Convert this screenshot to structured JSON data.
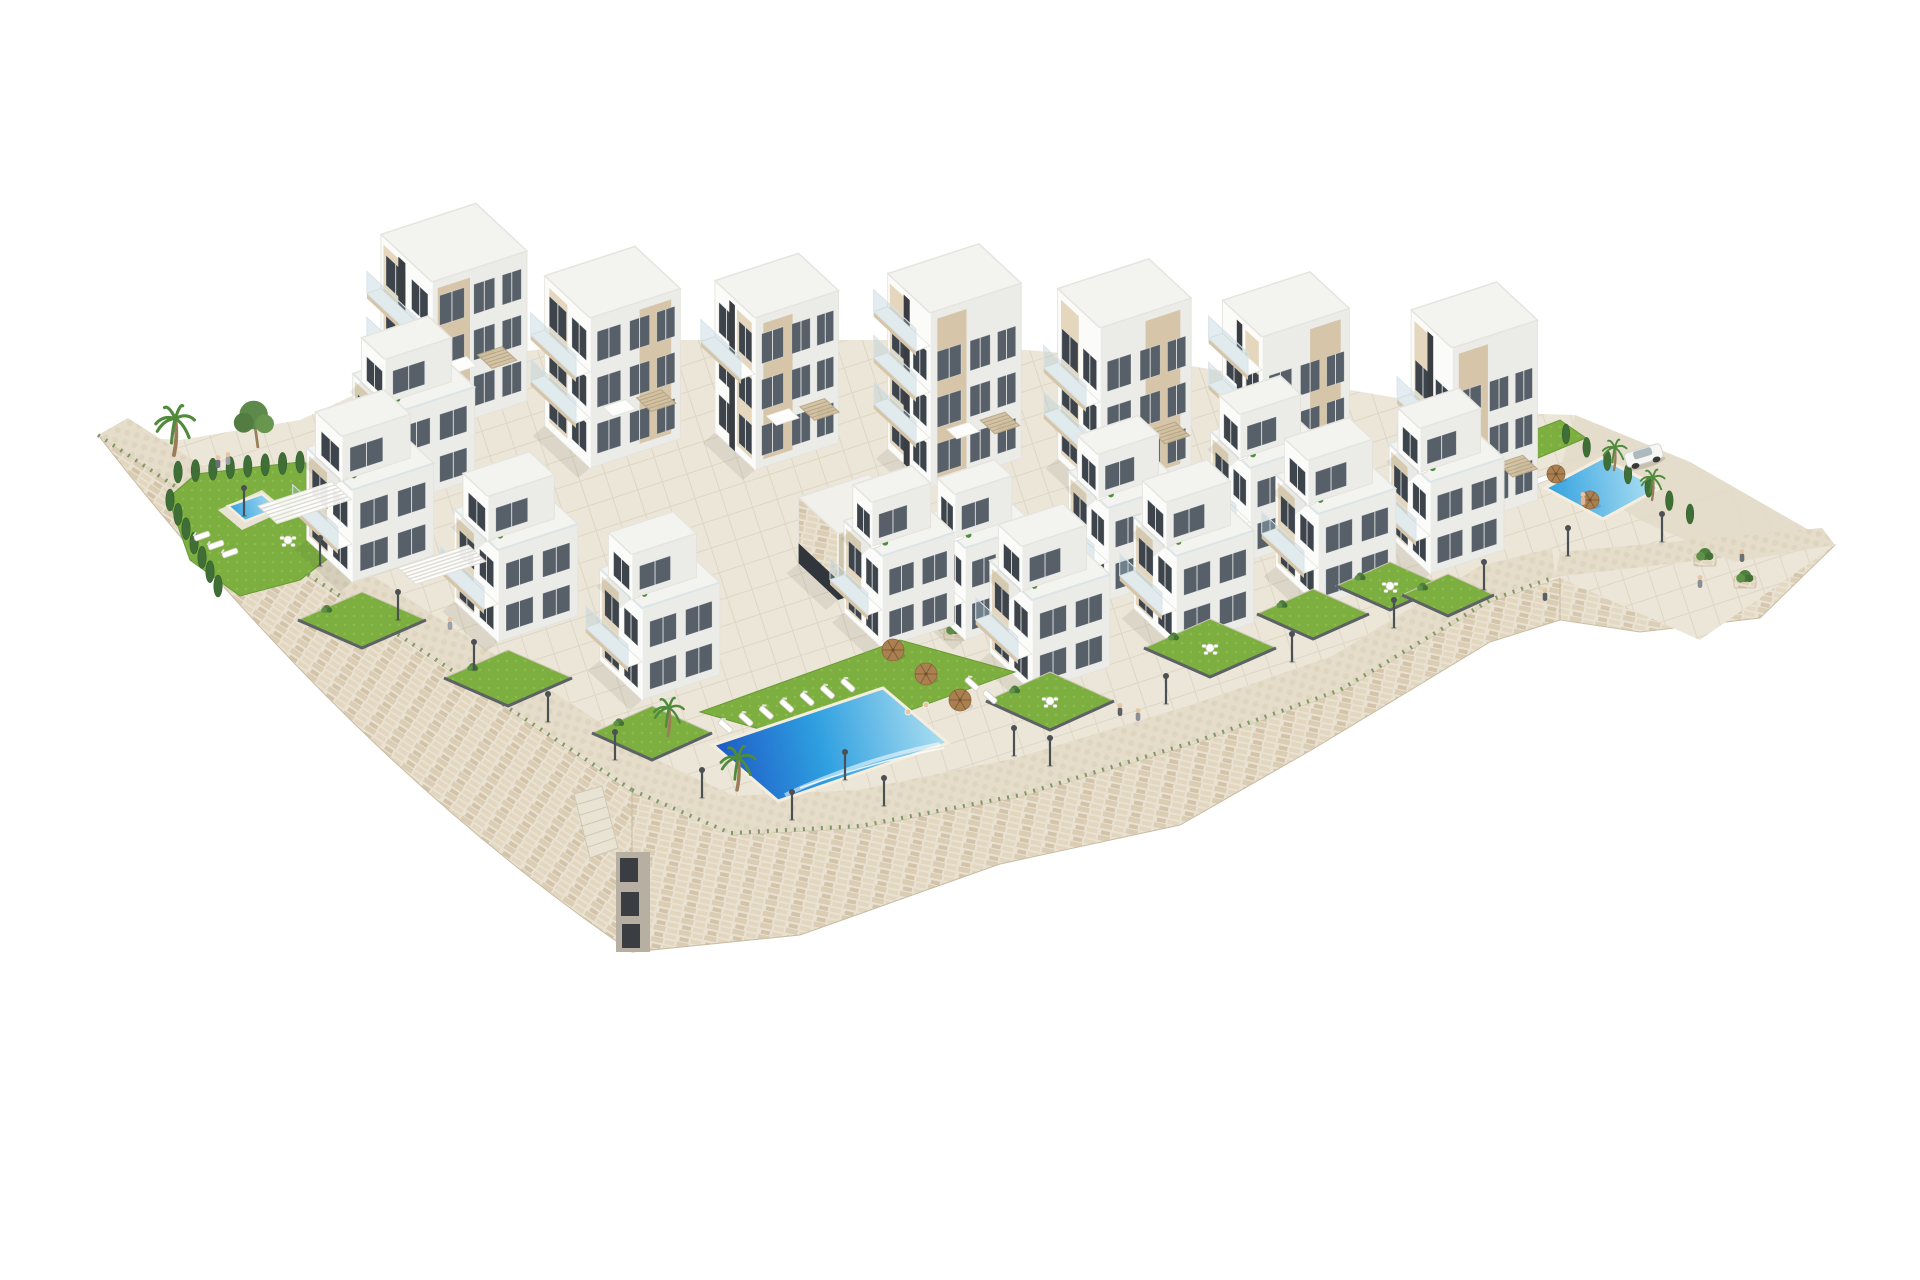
{
  "meta": {
    "description": "Aerial 3D architectural rendering of a white hillside apartment complex with stepped buildings, rooftop pergolas, private gardens, three swimming pools, stone retaining walls, lamp-lined promenades, palm trees and a parked car on a white background",
    "image_type": "3D architectural render",
    "counts": {
      "apartment_towers": 7,
      "front_villas": 8,
      "mid_villas": 4,
      "pools": 3,
      "lamp_posts": 18,
      "people": 11,
      "cars": 1
    }
  },
  "palette": {
    "bg": "#ffffff",
    "wallStone": "#e9e1d1",
    "wallCourseA": "#dbcdb4",
    "wallCourseB": "#e2d6bf",
    "wallCourseC": "#d3c4a9",
    "wallJoint": "#c9bba2",
    "pavement": "#ece6d9",
    "pavementLine": "#ded6c5",
    "promenade": "#e5ddc9",
    "cobble": "#dcd2bd",
    "slope": "#e4dbc8",
    "lawn": "#7caf3f",
    "lawnDot": "#8fbe52",
    "hedge": "#3f6f36",
    "hedgeDark": "#35602e",
    "poolDeep": "#1e56c4",
    "poolMid": "#2e9fe0",
    "poolLight": "#b5e3f2",
    "poolFoam": "#eef9fc",
    "white": "#fbfbf9",
    "whiteShade": "#ebebe7",
    "roof": "#f3f3f0",
    "roofLight": "#f7f8f6",
    "beigeL": "#e5d7bd",
    "beigeR": "#d6c5a8",
    "pergolaWood": "#d3c2a2",
    "pergolaLine": "#b6a686",
    "glassDark": "#3d444b",
    "glassMid": "#576069",
    "glassTint": "rgba(168,198,210,0.32)",
    "glassLine": "#d9e4e8",
    "charcoal": "#3a3e42",
    "fence": "#5c6165",
    "lamp": "#4b5054",
    "trunk": "#9b7d5a",
    "palm": "#4f8b3b",
    "pine": "#5d8a4a",
    "parasol": "#ab8050",
    "carBody": "#f6f6f4",
    "carGlass": "#aeb9be",
    "skin": "#e7c6a4",
    "edge": "#e3e1da",
    "shadow": "rgba(80,75,60,0.10)"
  },
  "scene": {
    "canvas": {
      "w": 1920,
      "h": 1280
    },
    "axes": {
      "dl": [
        -0.73,
        -0.68
      ],
      "dr": [
        0.95,
        -0.31
      ]
    },
    "plateau": [
      [
        98,
        435
      ],
      [
        180,
        440
      ],
      [
        300,
        420
      ],
      [
        430,
        360
      ],
      [
        640,
        340
      ],
      [
        900,
        340
      ],
      [
        1150,
        360
      ],
      [
        1350,
        390
      ],
      [
        1480,
        412
      ],
      [
        1575,
        415
      ],
      [
        1690,
        462
      ],
      [
        1835,
        545
      ],
      [
        1700,
        640
      ],
      [
        1560,
        578
      ],
      [
        1490,
        602
      ],
      [
        1340,
        692
      ],
      [
        1200,
        742
      ],
      [
        1020,
        797
      ],
      [
        858,
        827
      ],
      [
        728,
        835
      ],
      [
        632,
        792
      ]
    ],
    "slope": [
      [
        1575,
        415
      ],
      [
        1690,
        462
      ],
      [
        1835,
        545
      ],
      [
        1735,
        562
      ],
      [
        1640,
        520
      ],
      [
        1560,
        470
      ]
    ],
    "wallLeft": {
      "tip": [
        98,
        435
      ],
      "corner": [
        632,
        792
      ],
      "bottom": [
        632,
        952
      ],
      "ctrl": [
        350,
        760
      ]
    },
    "wallFront": [
      [
        632,
        792
      ],
      [
        730,
        835
      ],
      [
        860,
        828
      ],
      [
        1020,
        797
      ],
      [
        1200,
        742
      ],
      [
        1340,
        692
      ],
      [
        1490,
        602
      ],
      [
        1555,
        577
      ],
      [
        1552,
        548
      ],
      [
        1480,
        566
      ],
      [
        1332,
        656
      ],
      [
        1194,
        704
      ],
      [
        1016,
        758
      ],
      [
        858,
        790
      ],
      [
        734,
        796
      ],
      [
        644,
        754
      ]
    ],
    "wallFrontFace": [
      [
        632,
        792
      ],
      [
        730,
        835
      ],
      [
        860,
        828
      ],
      [
        1020,
        797
      ],
      [
        1200,
        742
      ],
      [
        1340,
        692
      ],
      [
        1490,
        602
      ],
      [
        1560,
        578
      ],
      [
        1560,
        620
      ],
      [
        1490,
        642
      ],
      [
        1313,
        749
      ],
      [
        1180,
        825
      ],
      [
        1000,
        864
      ],
      [
        800,
        935
      ],
      [
        632,
        952
      ]
    ],
    "wallRight": [
      [
        1560,
        578
      ],
      [
        1835,
        545
      ],
      [
        1760,
        618
      ],
      [
        1640,
        632
      ],
      [
        1560,
        620
      ]
    ],
    "promenadeLeft": [
      [
        98,
        435
      ],
      [
        632,
        790
      ],
      [
        646,
        752
      ],
      [
        128,
        418
      ]
    ],
    "promenadeRight": [
      [
        1555,
        577
      ],
      [
        1835,
        545
      ],
      [
        1822,
        528
      ],
      [
        1560,
        552
      ]
    ],
    "tuftLeft": [
      [
        98,
        435
      ],
      [
        632,
        790
      ]
    ],
    "tuftFront": [
      [
        632,
        790
      ],
      [
        730,
        833
      ],
      [
        860,
        826
      ],
      [
        1020,
        795
      ],
      [
        1200,
        740
      ],
      [
        1340,
        690
      ],
      [
        1490,
        600
      ],
      [
        1555,
        577
      ]
    ],
    "garageNotch": {
      "x": 616,
      "y": 852,
      "w": 34,
      "h": 100
    },
    "cornerStairs": [
      [
        574,
        794
      ],
      [
        602,
        786
      ],
      [
        618,
        848
      ],
      [
        590,
        858
      ]
    ],
    "towers": [
      {
        "name": "tower-1",
        "s": [
          432,
          432
        ],
        "wl": 70,
        "wr": 100,
        "h": 150,
        "slot": 0.52,
        "balconies": [
          1,
          2
        ],
        "panelL": [
          0.56,
          0.95
        ],
        "panelR": [
          0.06,
          0.4
        ]
      },
      {
        "name": "tower-2",
        "s": [
          590,
          468
        ],
        "wl": 62,
        "wr": 95,
        "h": 150,
        "balconies": [
          1,
          2
        ],
        "panelL": [
          0.5,
          0.9
        ],
        "panelR": [
          0.55,
          0.9
        ]
      },
      {
        "name": "tower-3",
        "s": [
          755,
          470
        ],
        "wl": 55,
        "wr": 88,
        "h": 152,
        "slot": 0.5,
        "balconies": [
          2
        ],
        "panelL": [
          0.08,
          0.45
        ],
        "panelR": [
          0.1,
          0.45
        ]
      },
      {
        "name": "tower-4",
        "s": [
          930,
          488
        ],
        "wl": 58,
        "wr": 96,
        "h": 175,
        "slot": 0.48,
        "balconies": [
          1,
          2,
          3
        ],
        "panelL": [
          0.55,
          0.95
        ],
        "panelR": [
          0.08,
          0.4
        ]
      },
      {
        "name": "tower-5",
        "s": [
          1100,
          498
        ],
        "wl": 58,
        "wr": 96,
        "h": 170,
        "balconies": [
          1,
          2
        ],
        "panelL": [
          0.5,
          0.92
        ],
        "panelR": [
          0.5,
          0.88
        ]
      },
      {
        "name": "tower-6",
        "s": [
          1262,
          512
        ],
        "wl": 54,
        "wr": 92,
        "h": 175,
        "slot": 0.5,
        "balconies": [
          2,
          3
        ],
        "panelL": [
          0.08,
          0.42
        ],
        "panelR": [
          0.55,
          0.9
        ]
      },
      {
        "name": "tower-7",
        "s": [
          1452,
          528
        ],
        "wl": 56,
        "wr": 90,
        "h": 180,
        "slot": 0.46,
        "balconies": [
          1,
          2
        ],
        "panelL": [
          0.52,
          0.92
        ],
        "panelR": [
          0.08,
          0.42
        ]
      }
    ],
    "towerWin": {
      "base": 12,
      "fh": 46,
      "wh": 30,
      "floors": 3,
      "colsL": [
        [
          0.08,
          0.4
        ],
        [
          0.52,
          0.9
        ]
      ],
      "colsR": [
        [
          0.08,
          0.34
        ],
        [
          0.44,
          0.66
        ],
        [
          0.74,
          0.94
        ]
      ]
    },
    "midVillas": [
      {
        "name": "mid-villa-1",
        "s": [
          395,
          505
        ],
        "wl": 58,
        "wr": 84
      },
      {
        "name": "mid-villa-2",
        "s": [
          965,
          640
        ],
        "wl": 50,
        "wr": 74
      },
      {
        "name": "mid-villa-3",
        "s": [
          1108,
          600
        ],
        "wl": 54,
        "wr": 78
      },
      {
        "name": "mid-villa-4",
        "s": [
          1250,
          560
        ],
        "wl": 54,
        "wr": 78
      }
    ],
    "villas": [
      {
        "name": "villa-1",
        "s": [
          352,
          582
        ],
        "wl": 62,
        "wr": 86
      },
      {
        "name": "villa-2",
        "s": [
          498,
          642
        ],
        "wl": 60,
        "wr": 84
      },
      {
        "name": "villa-3",
        "s": [
          642,
          700
        ],
        "wl": 58,
        "wr": 82
      },
      {
        "name": "villa-4",
        "s": [
          882,
          648
        ],
        "wl": 52,
        "wr": 76
      },
      {
        "name": "villa-5",
        "s": [
          1032,
          692
        ],
        "wl": 58,
        "wr": 82
      },
      {
        "name": "villa-6",
        "s": [
          1176,
          648
        ],
        "wl": 58,
        "wr": 82
      },
      {
        "name": "villa-7",
        "s": [
          1318,
          606
        ],
        "wl": 58,
        "wr": 82
      },
      {
        "name": "villa-8",
        "s": [
          1430,
          574
        ],
        "wl": 56,
        "wr": 78
      }
    ],
    "villaWin": {
      "base": 8,
      "fh": 42,
      "wh": 26,
      "floors": 2,
      "colsL": [
        [
          0.1,
          0.42
        ],
        [
          0.54,
          0.88
        ]
      ],
      "colsR": [
        [
          0.1,
          0.44
        ],
        [
          0.56,
          0.9
        ]
      ]
    },
    "gardens": [
      {
        "t": [
          362,
          592
        ],
        "gw": 64,
        "gh": 28
      },
      {
        "t": [
          508,
          650
        ],
        "gw": 64,
        "gh": 28
      },
      {
        "t": [
          652,
          706
        ],
        "gw": 60,
        "gh": 27
      },
      {
        "t": [
          1050,
          672
        ],
        "gw": 64,
        "gh": 29,
        "furniture": true
      },
      {
        "t": [
          1210,
          619
        ],
        "gw": 66,
        "gh": 29,
        "furniture": true
      },
      {
        "t": [
          1313,
          589
        ],
        "gw": 56,
        "gh": 25
      },
      {
        "t": [
          1390,
          562
        ],
        "gw": 54,
        "gh": 24,
        "furniture": true
      },
      {
        "t": [
          1448,
          574
        ],
        "gw": 46,
        "gh": 21
      }
    ],
    "entrance": {
      "s": [
        838,
        600
      ],
      "wl": 54,
      "wr": 74,
      "h": 66
    },
    "entranceStairs": {
      "a": [
        906,
        600
      ],
      "b": [
        968,
        580
      ],
      "steps": 6,
      "drop": [
        6.6,
        6.1
      ]
    },
    "planters": [
      [
        880,
        588
      ],
      [
        955,
        634
      ],
      [
        1705,
        560
      ],
      [
        1745,
        582
      ]
    ],
    "leftGarden": {
      "lawn": [
        [
          168,
          498
        ],
        [
          196,
          474
        ],
        [
          300,
          462
        ],
        [
          348,
          470
        ],
        [
          352,
          540
        ],
        [
          300,
          580
        ],
        [
          240,
          596
        ],
        [
          190,
          560
        ]
      ],
      "hedgeTop": {
        "a": [
          178,
          472
        ],
        "b": [
          300,
          462
        ],
        "n": 8
      },
      "hedgeSide": {
        "a": [
          170,
          500
        ],
        "b": [
          218,
          586
        ],
        "n": 7
      },
      "palm": [
        174,
        455
      ],
      "pine": [
        258,
        448
      ],
      "poolDeck": [
        [
          218,
          510
        ],
        [
          262,
          490
        ],
        [
          286,
          510
        ],
        [
          242,
          530
        ]
      ],
      "pool": [
        [
          228,
          506
        ],
        [
          262,
          494
        ],
        [
          279,
          508
        ],
        [
          245,
          521
        ]
      ],
      "loungers": [
        [
          202,
          536
        ],
        [
          216,
          545
        ],
        [
          230,
          553
        ]
      ],
      "table": [
        288,
        540
      ]
    },
    "pergolaTerraces": [
      {
        "p": [
          258,
          506
        ],
        "w": 78,
        "d": 26
      },
      {
        "p": [
          398,
          568
        ],
        "w": 74,
        "d": 24
      }
    ],
    "centralPool": {
      "lawn": [
        [
          700,
          712
        ],
        [
          900,
          640
        ],
        [
          1015,
          672
        ],
        [
          815,
          745
        ]
      ],
      "pool": [
        [
          713,
          745
        ],
        [
          883,
          688
        ],
        [
          948,
          743
        ],
        [
          778,
          801
        ]
      ],
      "loungerEdgeA": [
        713,
        745
      ],
      "loungerEdgeB": [
        883,
        688
      ],
      "loungerN": 7,
      "lawnLoungers": [
        [
          972,
          684
        ],
        [
          990,
          697
        ]
      ],
      "parasols": [
        [
          893,
          650
        ],
        [
          926,
          674
        ],
        [
          960,
          700
        ]
      ],
      "palms": [
        [
          737,
          790
        ],
        [
          668,
          736
        ]
      ],
      "swimmers": [
        [
          908,
          712
        ],
        [
          926,
          705
        ]
      ]
    },
    "rightTerrace": {
      "lawn": [
        [
          1488,
          448
        ],
        [
          1560,
          420
        ],
        [
          1586,
          438
        ],
        [
          1514,
          468
        ]
      ],
      "hedge": {
        "a": [
          1566,
          434
        ],
        "b": [
          1690,
          514
        ],
        "n": 7
      },
      "pool": [
        [
          1545,
          488
        ],
        [
          1602,
          458
        ],
        [
          1660,
          488
        ],
        [
          1603,
          519
        ]
      ],
      "loungers": [
        [
          1495,
          455
        ],
        [
          1511,
          463
        ],
        [
          1527,
          471
        ],
        [
          1543,
          479
        ]
      ],
      "parasols": [
        [
          1556,
          474
        ],
        [
          1590,
          500
        ]
      ],
      "palms": [
        [
          1614,
          470
        ],
        [
          1652,
          500
        ]
      ],
      "car": [
        1644,
        456
      ]
    },
    "lamps": [
      [
        244,
        516
      ],
      [
        320,
        566
      ],
      [
        398,
        620
      ],
      [
        474,
        670
      ],
      [
        548,
        722
      ],
      [
        615,
        760
      ],
      [
        702,
        798
      ],
      [
        792,
        820
      ],
      [
        845,
        780
      ],
      [
        884,
        806
      ],
      [
        1014,
        756
      ],
      [
        1050,
        766
      ],
      [
        1166,
        704
      ],
      [
        1292,
        662
      ],
      [
        1394,
        628
      ],
      [
        1484,
        590
      ],
      [
        1568,
        556
      ],
      [
        1662,
        542
      ]
    ],
    "people": [
      {
        "p": [
          218,
          468
        ],
        "c": "#6b7076"
      },
      {
        "p": [
          228,
          465
        ],
        "c": "#9aa0a5"
      },
      {
        "p": [
          1120,
          716
        ],
        "c": "#5a6066"
      },
      {
        "p": [
          1138,
          721
        ],
        "c": "#8a8f94"
      },
      {
        "p": [
          1583,
          505
        ],
        "c": "#e2b498"
      },
      {
        "p": [
          1545,
          601
        ],
        "c": "#5a6066"
      },
      {
        "p": [
          1700,
          588
        ],
        "c": "#8a8f94"
      },
      {
        "p": [
          1742,
          562
        ],
        "c": "#6b7076"
      },
      {
        "p": [
          450,
          630
        ],
        "c": "#9aa0a5"
      }
    ]
  }
}
